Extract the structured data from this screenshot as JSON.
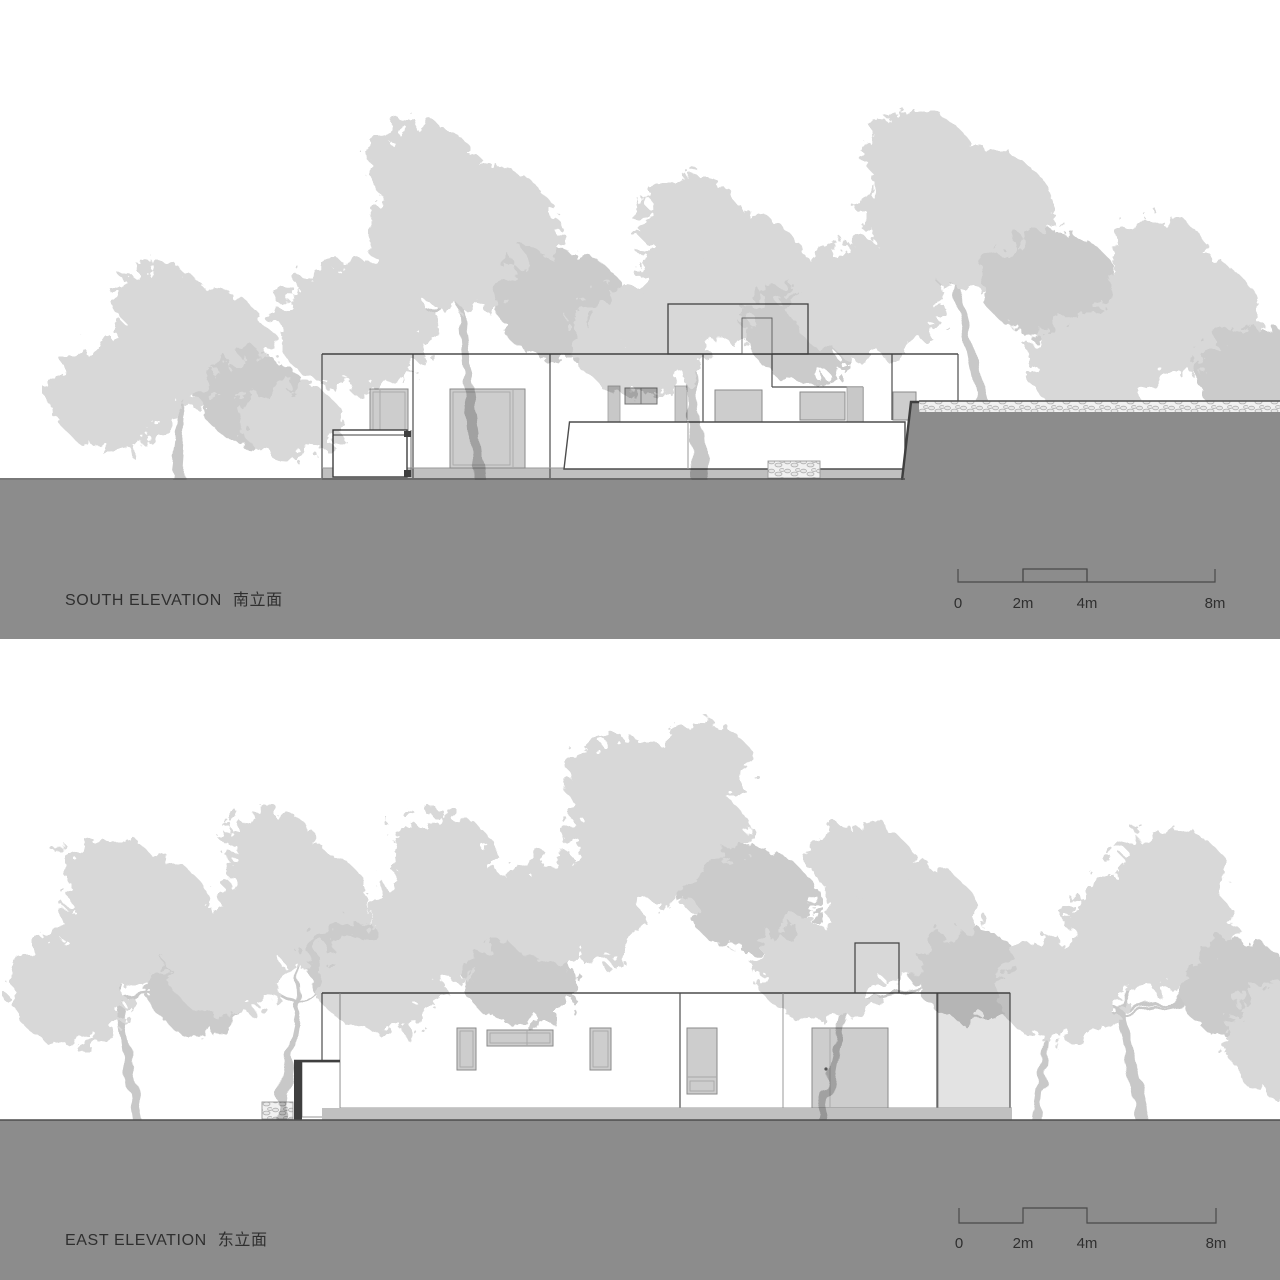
{
  "title_block": {
    "south": {
      "label_en": "SOUTH ELEVATION",
      "label_zh": "南立面"
    },
    "east": {
      "label_en": "EAST ELEVATION",
      "label_zh": "东立面"
    }
  },
  "scale_bar": {
    "ticks": [
      "0",
      "2m",
      "4m",
      "8m"
    ]
  },
  "colors": {
    "ground": "#8c8c8c",
    "plinth": "#c0c0c0",
    "foliage": "#d8d8d8",
    "foliage2": "#cbcbcb",
    "trunk": "#c8c8c8",
    "line": "#4d4d4d",
    "text": "#2f2f2f"
  }
}
